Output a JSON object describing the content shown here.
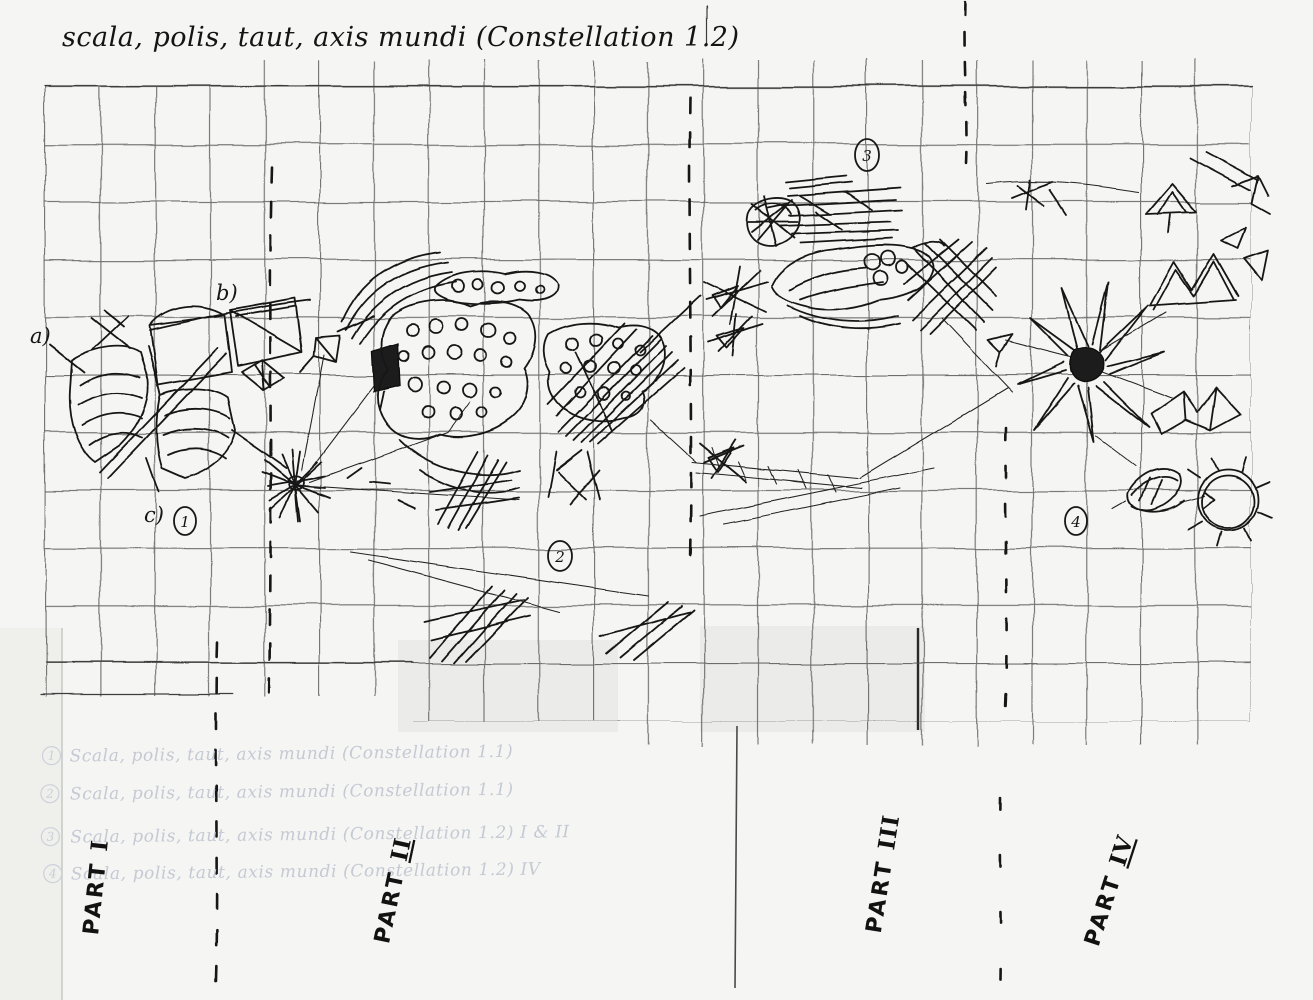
{
  "header": {
    "title": "scala, polis, taut, axis mundi (Constellation 1.2)"
  },
  "annotations": {
    "a": "a)",
    "b": "b)",
    "c": "c)"
  },
  "markers": [
    "1",
    "2",
    "3",
    "4"
  ],
  "parts": [
    {
      "label": "PART",
      "numeral": "I",
      "underline": false
    },
    {
      "label": "PART",
      "numeral": "II",
      "underline": true
    },
    {
      "label": "PART",
      "numeral": "III",
      "underline": false
    },
    {
      "label": "PART",
      "numeral": "IV",
      "underline": true
    }
  ],
  "ghost": {
    "lines": [
      {
        "num": "1",
        "text": "Scala, polis, taut, axis mundi (Constellation 1.1)"
      },
      {
        "num": "2",
        "text": "Scala, polis, taut, axis mundi (Constellation 1.1)"
      },
      {
        "num": "3",
        "text": "Scala, polis, taut, axis mundi (Constellation 1.2)  I & II"
      },
      {
        "num": "4",
        "text": "Scala, polis, taut, axis mundi (Constellation 1.2)  IV"
      }
    ]
  },
  "colors": {
    "ink": "#171717",
    "grid_line": "#4e4e4e",
    "paper": "#f5f5f3",
    "ghost_text": "#c4c9d3"
  }
}
